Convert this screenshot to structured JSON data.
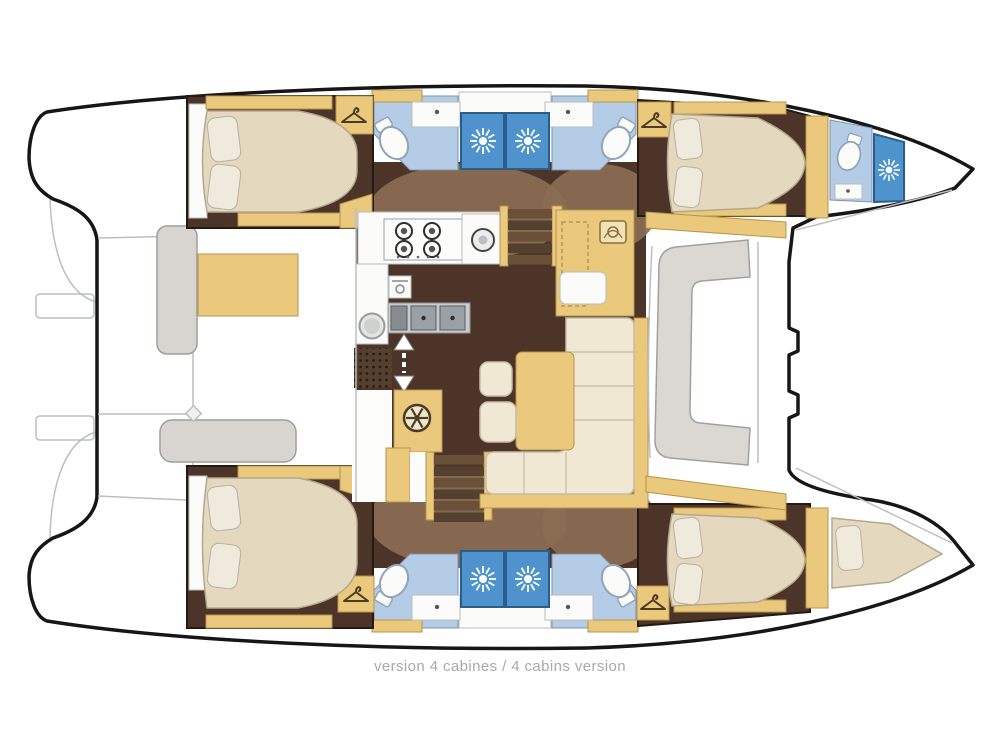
{
  "caption": {
    "text": "version 4 cabines / 4 cabins version"
  },
  "palette": {
    "background": "#ffffff",
    "hull_outline": "#161616",
    "detail_line": "#bcbfc2",
    "floor_dark": "#4d3429",
    "floor_mid": "#8a6d52",
    "wood_tan": "#eac87c",
    "wood_edge": "#b8934e",
    "bed_beige": "#e4d8bf",
    "pillow": "#f0eadd",
    "bath_floor": "#b5cce7",
    "shower_blue": "#4f93cd",
    "fixture_white": "#fbfbf9",
    "counter_gray": "#c9cccc",
    "sink_gray": "#9aa1a6",
    "sofa_cream": "#f0e8d2",
    "cushion_gray": "#d8d5d0",
    "caption_gray": "#a9a9a9"
  },
  "diagram": {
    "type": "catamaran-deck-plan",
    "layout": "4 cabins",
    "counts": {
      "double_bed_cabins": 4,
      "bow_berths": 1,
      "toilets": 5,
      "showers": 5,
      "wash_basins": 5,
      "companionway_stairs": 2
    },
    "areas": [
      "top-hull-aft-cabin",
      "top-hull-bathrooms",
      "top-hull-forward-cabin",
      "bow-bathroom",
      "bottom-hull-aft-cabin",
      "bottom-hull-bathrooms",
      "bottom-hull-forward-cabin",
      "bow-berth",
      "aft-cockpit",
      "saloon",
      "galley",
      "navigation-station",
      "dinette",
      "forward-cockpit"
    ],
    "icons": [
      "shower-sunburst-icon",
      "clothes-hanger-icon",
      "toilet-icon",
      "stove-burners-icon",
      "single-burner-icon",
      "double-sink-icon",
      "washing-machine-icon",
      "oven-icon",
      "helm-wheel-icon",
      "entry-arrows-icon",
      "nav-instrument-icon",
      "cleat-icon"
    ]
  }
}
